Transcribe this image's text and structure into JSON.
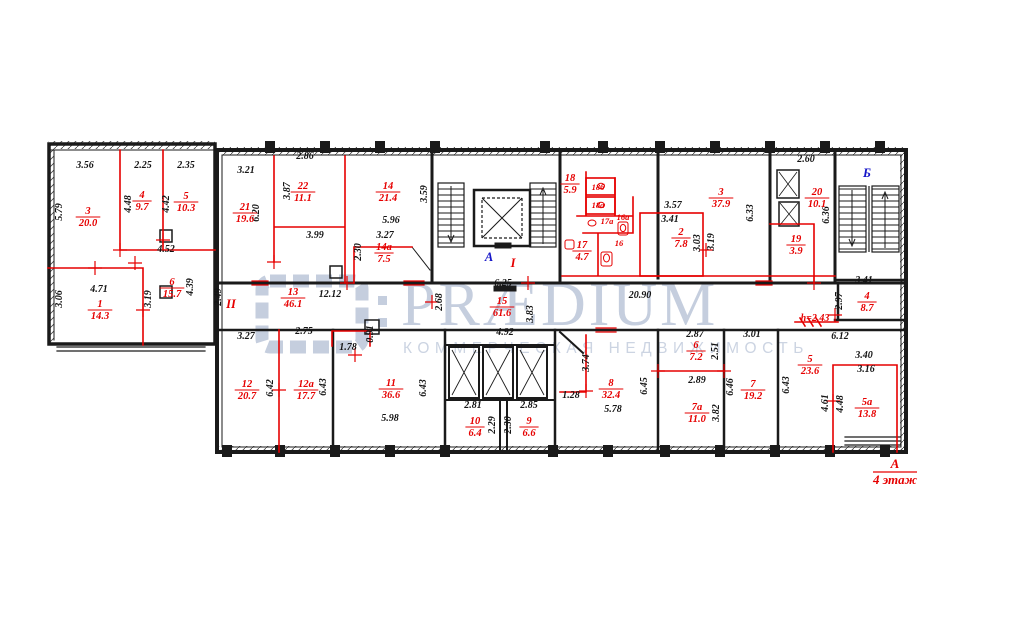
{
  "watermark": {
    "brand": "PRÆDIUM",
    "subtitle": "КОММЕРЧЕСКАЯ НЕДВИЖИМОСТЬ"
  },
  "title_block": {
    "axis": "А",
    "floor": "4 этаж"
  },
  "colors": {
    "wall": "#1a1a1a",
    "annotation_red": "#e60000",
    "marker_blue": "#1515c8",
    "watermark": "#c5cede"
  },
  "axis_markers": [
    {
      "text": "А",
      "style": "blue",
      "x": 489,
      "y": 261
    },
    {
      "text": "I",
      "style": "red",
      "x": 513,
      "y": 267
    },
    {
      "text": "Б",
      "style": "blue",
      "x": 867,
      "y": 177
    },
    {
      "text": "II",
      "style": "red",
      "x": 231,
      "y": 308
    }
  ],
  "rooms": [
    {
      "num": "3",
      "area": "20.0",
      "x": 88,
      "y": 216
    },
    {
      "num": "4",
      "area": "9.7",
      "x": 142,
      "y": 200
    },
    {
      "num": "5",
      "area": "10.3",
      "x": 186,
      "y": 201
    },
    {
      "num": "6",
      "area": "15.7",
      "x": 172,
      "y": 287
    },
    {
      "num": "1",
      "area": "14.3",
      "x": 100,
      "y": 309
    },
    {
      "num": "21",
      "area": "19.6",
      "x": 245,
      "y": 212
    },
    {
      "num": "22",
      "area": "11.1",
      "x": 303,
      "y": 191
    },
    {
      "num": "14",
      "area": "21.4",
      "x": 388,
      "y": 191
    },
    {
      "num": "14а",
      "area": "7.5",
      "x": 384,
      "y": 252
    },
    {
      "num": "13",
      "area": "46.1",
      "x": 293,
      "y": 297
    },
    {
      "num": "15",
      "area": "61.6",
      "x": 502,
      "y": 306
    },
    {
      "num": "18",
      "area": "5.9",
      "x": 570,
      "y": 183
    },
    {
      "num": "17",
      "area": "4.7",
      "x": 582,
      "y": 250
    },
    {
      "num": "2",
      "area": "7.8",
      "x": 681,
      "y": 237
    },
    {
      "num": "3",
      "area": "37.9",
      "x": 721,
      "y": 197
    },
    {
      "num": "19",
      "area": "3.9",
      "x": 796,
      "y": 244
    },
    {
      "num": "20",
      "area": "10.1",
      "x": 817,
      "y": 197
    },
    {
      "num": "4",
      "area": "8.7",
      "x": 867,
      "y": 301
    },
    {
      "num": "5",
      "area": "23.6",
      "x": 810,
      "y": 364
    },
    {
      "num": "5а",
      "area": "13.8",
      "x": 867,
      "y": 407
    },
    {
      "num": "12",
      "area": "20.7",
      "x": 247,
      "y": 389
    },
    {
      "num": "12а",
      "area": "17.7",
      "x": 306,
      "y": 389
    },
    {
      "num": "11",
      "area": "36.6",
      "x": 391,
      "y": 388
    },
    {
      "num": "10",
      "area": "6.4",
      "x": 475,
      "y": 426
    },
    {
      "num": "9",
      "area": "6.6",
      "x": 529,
      "y": 426
    },
    {
      "num": "8",
      "area": "32.4",
      "x": 611,
      "y": 388
    },
    {
      "num": "6",
      "area": "7.2",
      "x": 696,
      "y": 350
    },
    {
      "num": "7а",
      "area": "11.0",
      "x": 697,
      "y": 412
    },
    {
      "num": "7",
      "area": "19.2",
      "x": 753,
      "y": 389
    }
  ],
  "small_labels": [
    {
      "text": "18б",
      "x": 598,
      "y": 190
    },
    {
      "text": "18а",
      "x": 598,
      "y": 208
    },
    {
      "text": "17а",
      "x": 607,
      "y": 224
    },
    {
      "text": "16а",
      "x": 623,
      "y": 220
    },
    {
      "text": "16",
      "x": 619,
      "y": 246
    }
  ],
  "dimensions": [
    {
      "t": "3.56",
      "x": 85,
      "y": 168
    },
    {
      "t": "2.25",
      "x": 143,
      "y": 168
    },
    {
      "t": "2.35",
      "x": 186,
      "y": 168
    },
    {
      "t": "5.79",
      "x": 62,
      "y": 212,
      "r": 1
    },
    {
      "t": "4.48",
      "x": 131,
      "y": 204,
      "r": 1
    },
    {
      "t": "4.42",
      "x": 169,
      "y": 204,
      "r": 1
    },
    {
      "t": "4.52",
      "x": 166,
      "y": 252
    },
    {
      "t": "3.06",
      "x": 62,
      "y": 299,
      "r": 1
    },
    {
      "t": "4.71",
      "x": 99,
      "y": 292
    },
    {
      "t": "3.19",
      "x": 151,
      "y": 299,
      "r": 1
    },
    {
      "t": "4.39",
      "x": 193,
      "y": 287,
      "r": 1
    },
    {
      "t": "2.49",
      "x": 221,
      "y": 297,
      "r": 1
    },
    {
      "t": "3.21",
      "x": 246,
      "y": 173
    },
    {
      "t": "2.86",
      "x": 305,
      "y": 159
    },
    {
      "t": "3.87",
      "x": 290,
      "y": 191,
      "r": 1
    },
    {
      "t": "6.20",
      "x": 259,
      "y": 213,
      "r": 1
    },
    {
      "t": "3.99",
      "x": 315,
      "y": 238
    },
    {
      "t": "5.96",
      "x": 391,
      "y": 223
    },
    {
      "t": "3.27",
      "x": 385,
      "y": 238
    },
    {
      "t": "2.30",
      "x": 361,
      "y": 252,
      "r": 1
    },
    {
      "t": "3.59",
      "x": 427,
      "y": 194,
      "r": 1
    },
    {
      "t": "6.25",
      "x": 503,
      "y": 286
    },
    {
      "t": "2.68",
      "x": 442,
      "y": 302,
      "r": 1
    },
    {
      "t": "3.83",
      "x": 533,
      "y": 314,
      "r": 1
    },
    {
      "t": "12.12",
      "x": 330,
      "y": 297
    },
    {
      "t": "3.57",
      "x": 673,
      "y": 208
    },
    {
      "t": "3.41",
      "x": 670,
      "y": 222
    },
    {
      "t": "3.03",
      "x": 700,
      "y": 243,
      "r": 1
    },
    {
      "t": "3.19",
      "x": 714,
      "y": 242,
      "r": 1
    },
    {
      "t": "6.33",
      "x": 753,
      "y": 213,
      "r": 1
    },
    {
      "t": "2.60",
      "x": 806,
      "y": 162
    },
    {
      "t": "6.36",
      "x": 829,
      "y": 215,
      "r": 1
    },
    {
      "t": "3.41",
      "x": 864,
      "y": 283
    },
    {
      "t": "2.97",
      "x": 842,
      "y": 301,
      "r": 1
    },
    {
      "t": "6.12",
      "x": 840,
      "y": 339
    },
    {
      "t": "3.40",
      "x": 864,
      "y": 358
    },
    {
      "t": "3.16",
      "x": 866,
      "y": 372
    },
    {
      "t": "4.61",
      "x": 828,
      "y": 403,
      "r": 1
    },
    {
      "t": "4.48",
      "x": 843,
      "y": 404,
      "r": 1
    },
    {
      "t": "20.90",
      "x": 640,
      "y": 298
    },
    {
      "t": "4.92",
      "x": 505,
      "y": 335
    },
    {
      "t": "3.74",
      "x": 589,
      "y": 363,
      "r": 1
    },
    {
      "t": "1.28",
      "x": 571,
      "y": 398
    },
    {
      "t": "5.78",
      "x": 613,
      "y": 412
    },
    {
      "t": "6.45",
      "x": 647,
      "y": 386,
      "r": 1
    },
    {
      "t": "2.87",
      "x": 695,
      "y": 337
    },
    {
      "t": "2.51",
      "x": 718,
      "y": 351,
      "r": 1
    },
    {
      "t": "3.01",
      "x": 752,
      "y": 337
    },
    {
      "t": "2.89",
      "x": 697,
      "y": 383
    },
    {
      "t": "6.46",
      "x": 733,
      "y": 387,
      "r": 1
    },
    {
      "t": "3.82",
      "x": 719,
      "y": 413,
      "r": 1
    },
    {
      "t": "6.43",
      "x": 789,
      "y": 385,
      "r": 1
    },
    {
      "t": "3.27",
      "x": 246,
      "y": 339
    },
    {
      "t": "2.75",
      "x": 304,
      "y": 334
    },
    {
      "t": "1.78",
      "x": 348,
      "y": 350
    },
    {
      "t": "0.91",
      "x": 373,
      "y": 334,
      "r": 1
    },
    {
      "t": "6.42",
      "x": 273,
      "y": 388,
      "r": 1
    },
    {
      "t": "6.43",
      "x": 326,
      "y": 387,
      "r": 1
    },
    {
      "t": "6.43",
      "x": 426,
      "y": 388,
      "r": 1
    },
    {
      "t": "5.98",
      "x": 390,
      "y": 421
    },
    {
      "t": "2.81",
      "x": 473,
      "y": 408
    },
    {
      "t": "2.29",
      "x": 495,
      "y": 425,
      "r": 1
    },
    {
      "t": "2.30",
      "x": 511,
      "y": 425,
      "r": 1
    },
    {
      "t": "2.85",
      "x": 529,
      "y": 408
    },
    {
      "t": "h=2.43",
      "x": 815,
      "y": 321,
      "red": 1
    }
  ]
}
